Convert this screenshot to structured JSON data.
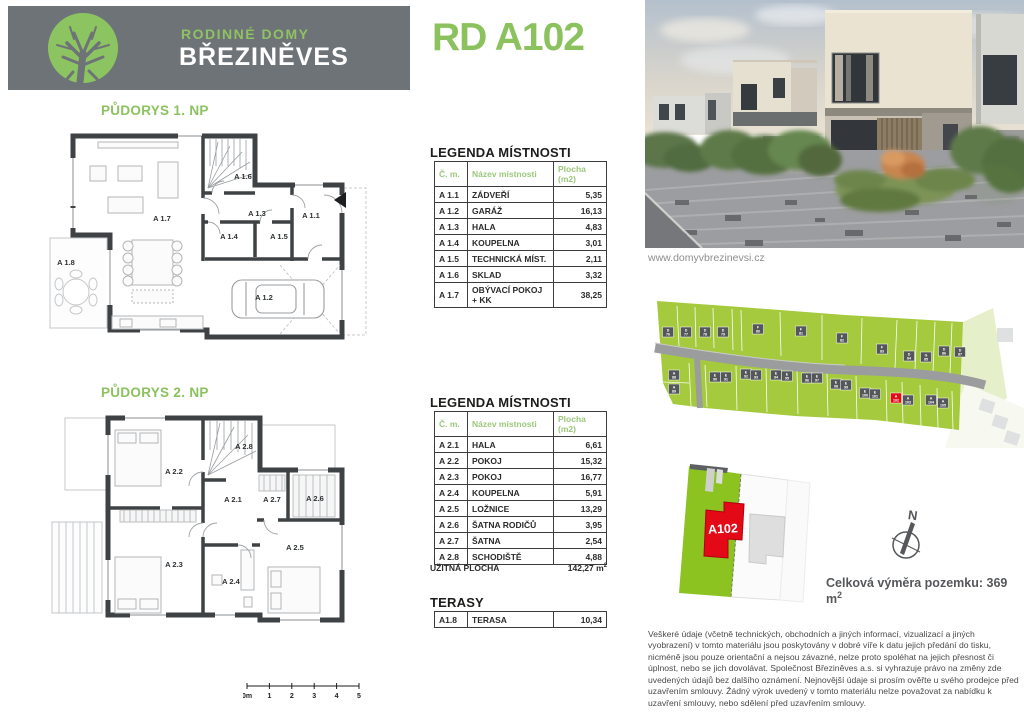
{
  "colors": {
    "green": "#8bc25e",
    "header_gray": "#6e7377",
    "table_header_green": "#9cc77c",
    "site_green": "#a5ca3e",
    "road_gray": "#9b9c9e",
    "house_gray": "#54575a",
    "red": "#e30917",
    "wall_dark": "#3e4244",
    "note_gray": "#55575a"
  },
  "header": {
    "logo": "tree-icon",
    "brand_top": "RODINNÉ DOMY",
    "brand_bottom": "BŘEZINĚVES",
    "title": "RD A102"
  },
  "photo": {
    "caption": "www.domyvbrezinevsi.cz"
  },
  "plan1": {
    "heading": "PŮDORYS 1. NP",
    "room_labels": [
      {
        "t": "A 1.7",
        "x": 122,
        "y": 121
      },
      {
        "t": "A 1.6",
        "x": 203,
        "y": 79
      },
      {
        "t": "A 1.3",
        "x": 217,
        "y": 116
      },
      {
        "t": "A 1.1",
        "x": 271,
        "y": 118
      },
      {
        "t": "A 1.4",
        "x": 189,
        "y": 139
      },
      {
        "t": "A 1.5",
        "x": 239,
        "y": 139
      },
      {
        "t": "A 1.8",
        "x": 26,
        "y": 165
      },
      {
        "t": "A 1.2",
        "x": 224,
        "y": 200
      }
    ]
  },
  "plan2": {
    "heading": "PŮDORYS 2. NP",
    "room_labels": [
      {
        "t": "A 2.2",
        "x": 134,
        "y": 99
      },
      {
        "t": "A 2.8",
        "x": 204,
        "y": 74
      },
      {
        "t": "A 2.1",
        "x": 193,
        "y": 127
      },
      {
        "t": "A 2.7",
        "x": 232,
        "y": 127
      },
      {
        "t": "A 2.6",
        "x": 275,
        "y": 126
      },
      {
        "t": "A 2.5",
        "x": 255,
        "y": 175
      },
      {
        "t": "A 2.3",
        "x": 134,
        "y": 192
      },
      {
        "t": "A 2.4",
        "x": 191,
        "y": 209
      }
    ]
  },
  "legend1": {
    "heading": "LEGENDA MÍSTNOSTI",
    "columns": [
      "Č. m.",
      "Název místnosti",
      "Plocha (m2)"
    ],
    "rows": [
      [
        "A 1.1",
        "ZÁDVEŘÍ",
        "5,35"
      ],
      [
        "A 1.2",
        "GARÁŽ",
        "16,13"
      ],
      [
        "A 1.3",
        "HALA",
        "4,83"
      ],
      [
        "A 1.4",
        "KOUPELNA",
        "3,01"
      ],
      [
        "A 1.5",
        "TECHNICKÁ MÍST.",
        "2,11"
      ],
      [
        "A 1.6",
        "SKLAD",
        "3,32"
      ],
      [
        "A 1.7",
        "OBÝVACÍ POKOJ\n+ KK",
        "38,25"
      ]
    ]
  },
  "legend2": {
    "heading": "LEGENDA MÍSTNOSTI",
    "columns": [
      "Č. m.",
      "Název místnosti",
      "Plocha (m2)"
    ],
    "rows": [
      [
        "A 2.1",
        "HALA",
        "6,61"
      ],
      [
        "A 2.2",
        "POKOJ",
        "15,32"
      ],
      [
        "A 2.3",
        "POKOJ",
        "16,77"
      ],
      [
        "A 2.4",
        "KOUPELNA",
        "5,91"
      ],
      [
        "A 2.5",
        "LOŽNICE",
        "13,29"
      ],
      [
        "A 2.6",
        "ŠATNA RODIČŮ",
        "3,95"
      ],
      [
        "A 2.7",
        "ŠATNA",
        "2,54"
      ],
      [
        "A 2.8",
        "SCHODIŠTĚ",
        "4,88"
      ]
    ],
    "total_label": "UŽITNÁ PLOCHA",
    "total_value": "142,27 m",
    "total_sup": "2"
  },
  "terasy": {
    "heading": "TERASY",
    "rows": [
      [
        "A1.8",
        "TERASA",
        "10,34"
      ]
    ]
  },
  "siteplan": {
    "houses": [
      {
        "l": "D",
        "n": "76",
        "x": 23,
        "y": 44
      },
      {
        "l": "D",
        "n": "77",
        "x": 41,
        "y": 44
      },
      {
        "l": "D",
        "n": "78",
        "x": 60,
        "y": 44
      },
      {
        "l": "D",
        "n": "79",
        "x": 78,
        "y": 44
      },
      {
        "l": "F",
        "n": "80",
        "x": 113,
        "y": 41
      },
      {
        "l": "F",
        "n": "81",
        "x": 156,
        "y": 43
      },
      {
        "l": "F",
        "n": "82",
        "x": 197,
        "y": 50
      },
      {
        "l": "F",
        "n": "83",
        "x": 237,
        "y": 61
      },
      {
        "l": "D",
        "n": "84",
        "x": 264,
        "y": 68
      },
      {
        "l": "G",
        "n": "85",
        "x": 281,
        "y": 69
      },
      {
        "l": "D",
        "n": "86",
        "x": 299,
        "y": 63
      },
      {
        "l": "D",
        "n": "87",
        "x": 315,
        "y": 64
      },
      {
        "l": "A",
        "n": "88",
        "x": 29,
        "y": 87
      },
      {
        "l": "A",
        "n": "89",
        "x": 29,
        "y": 101
      },
      {
        "l": "E",
        "n": "90",
        "x": 70,
        "y": 89
      },
      {
        "l": "E",
        "n": "91",
        "x": 81,
        "y": 89
      },
      {
        "l": "E",
        "n": "92",
        "x": 101,
        "y": 86
      },
      {
        "l": "E",
        "n": "93",
        "x": 111,
        "y": 87
      },
      {
        "l": "E",
        "n": "94",
        "x": 131,
        "y": 87
      },
      {
        "l": "E",
        "n": "95",
        "x": 142,
        "y": 88
      },
      {
        "l": "E",
        "n": "96",
        "x": 162,
        "y": 90
      },
      {
        "l": "E",
        "n": "97",
        "x": 172,
        "y": 90
      },
      {
        "l": "E",
        "n": "98",
        "x": 191,
        "y": 96
      },
      {
        "l": "E",
        "n": "99",
        "x": 201,
        "y": 97
      },
      {
        "l": "E",
        "n": "100",
        "x": 220,
        "y": 105
      },
      {
        "l": "E",
        "n": "101",
        "x": 230,
        "y": 106
      },
      {
        "l": "A",
        "n": "102",
        "x": 251,
        "y": 110,
        "red": true
      },
      {
        "l": "A",
        "n": "103",
        "x": 263,
        "y": 112
      },
      {
        "l": "A",
        "n": "104",
        "x": 286,
        "y": 112
      },
      {
        "l": "A",
        "n": "105",
        "x": 298,
        "y": 115
      }
    ]
  },
  "sitedetail": {
    "label": "A102"
  },
  "compass": {
    "north": "N"
  },
  "area_note": {
    "text": "Celková výměra pozemku: 369 m",
    "sup": "2"
  },
  "scalebar": {
    "labels": [
      "0m",
      "1",
      "2",
      "3",
      "4",
      "5"
    ]
  },
  "disclaimer": "Veškeré údaje (včetně technických, obchodních a jiných informací, vizualizací a jiných vyobrazení) v tomto materiálu jsou poskytovány v dobré víře k datu jejich předání do tisku, nicméně jsou pouze orientační a nejsou závazné, nelze proto spoléhat na jejich přesnost či úplnost, nebo se jich dovolávat. Společnost Březiněves a.s. si vyhrazuje právo na změny zde uvedených údajů bez dalšího oznámení. Nejnovější údaje si prosím ověřte u svého prodejce před uzavřením smlouvy. Žádný výrok uvedený v tomto materiálu nelze považovat za nabídku k uzavření smlouvy, nebo sdělení před uzavřením smlouvy."
}
